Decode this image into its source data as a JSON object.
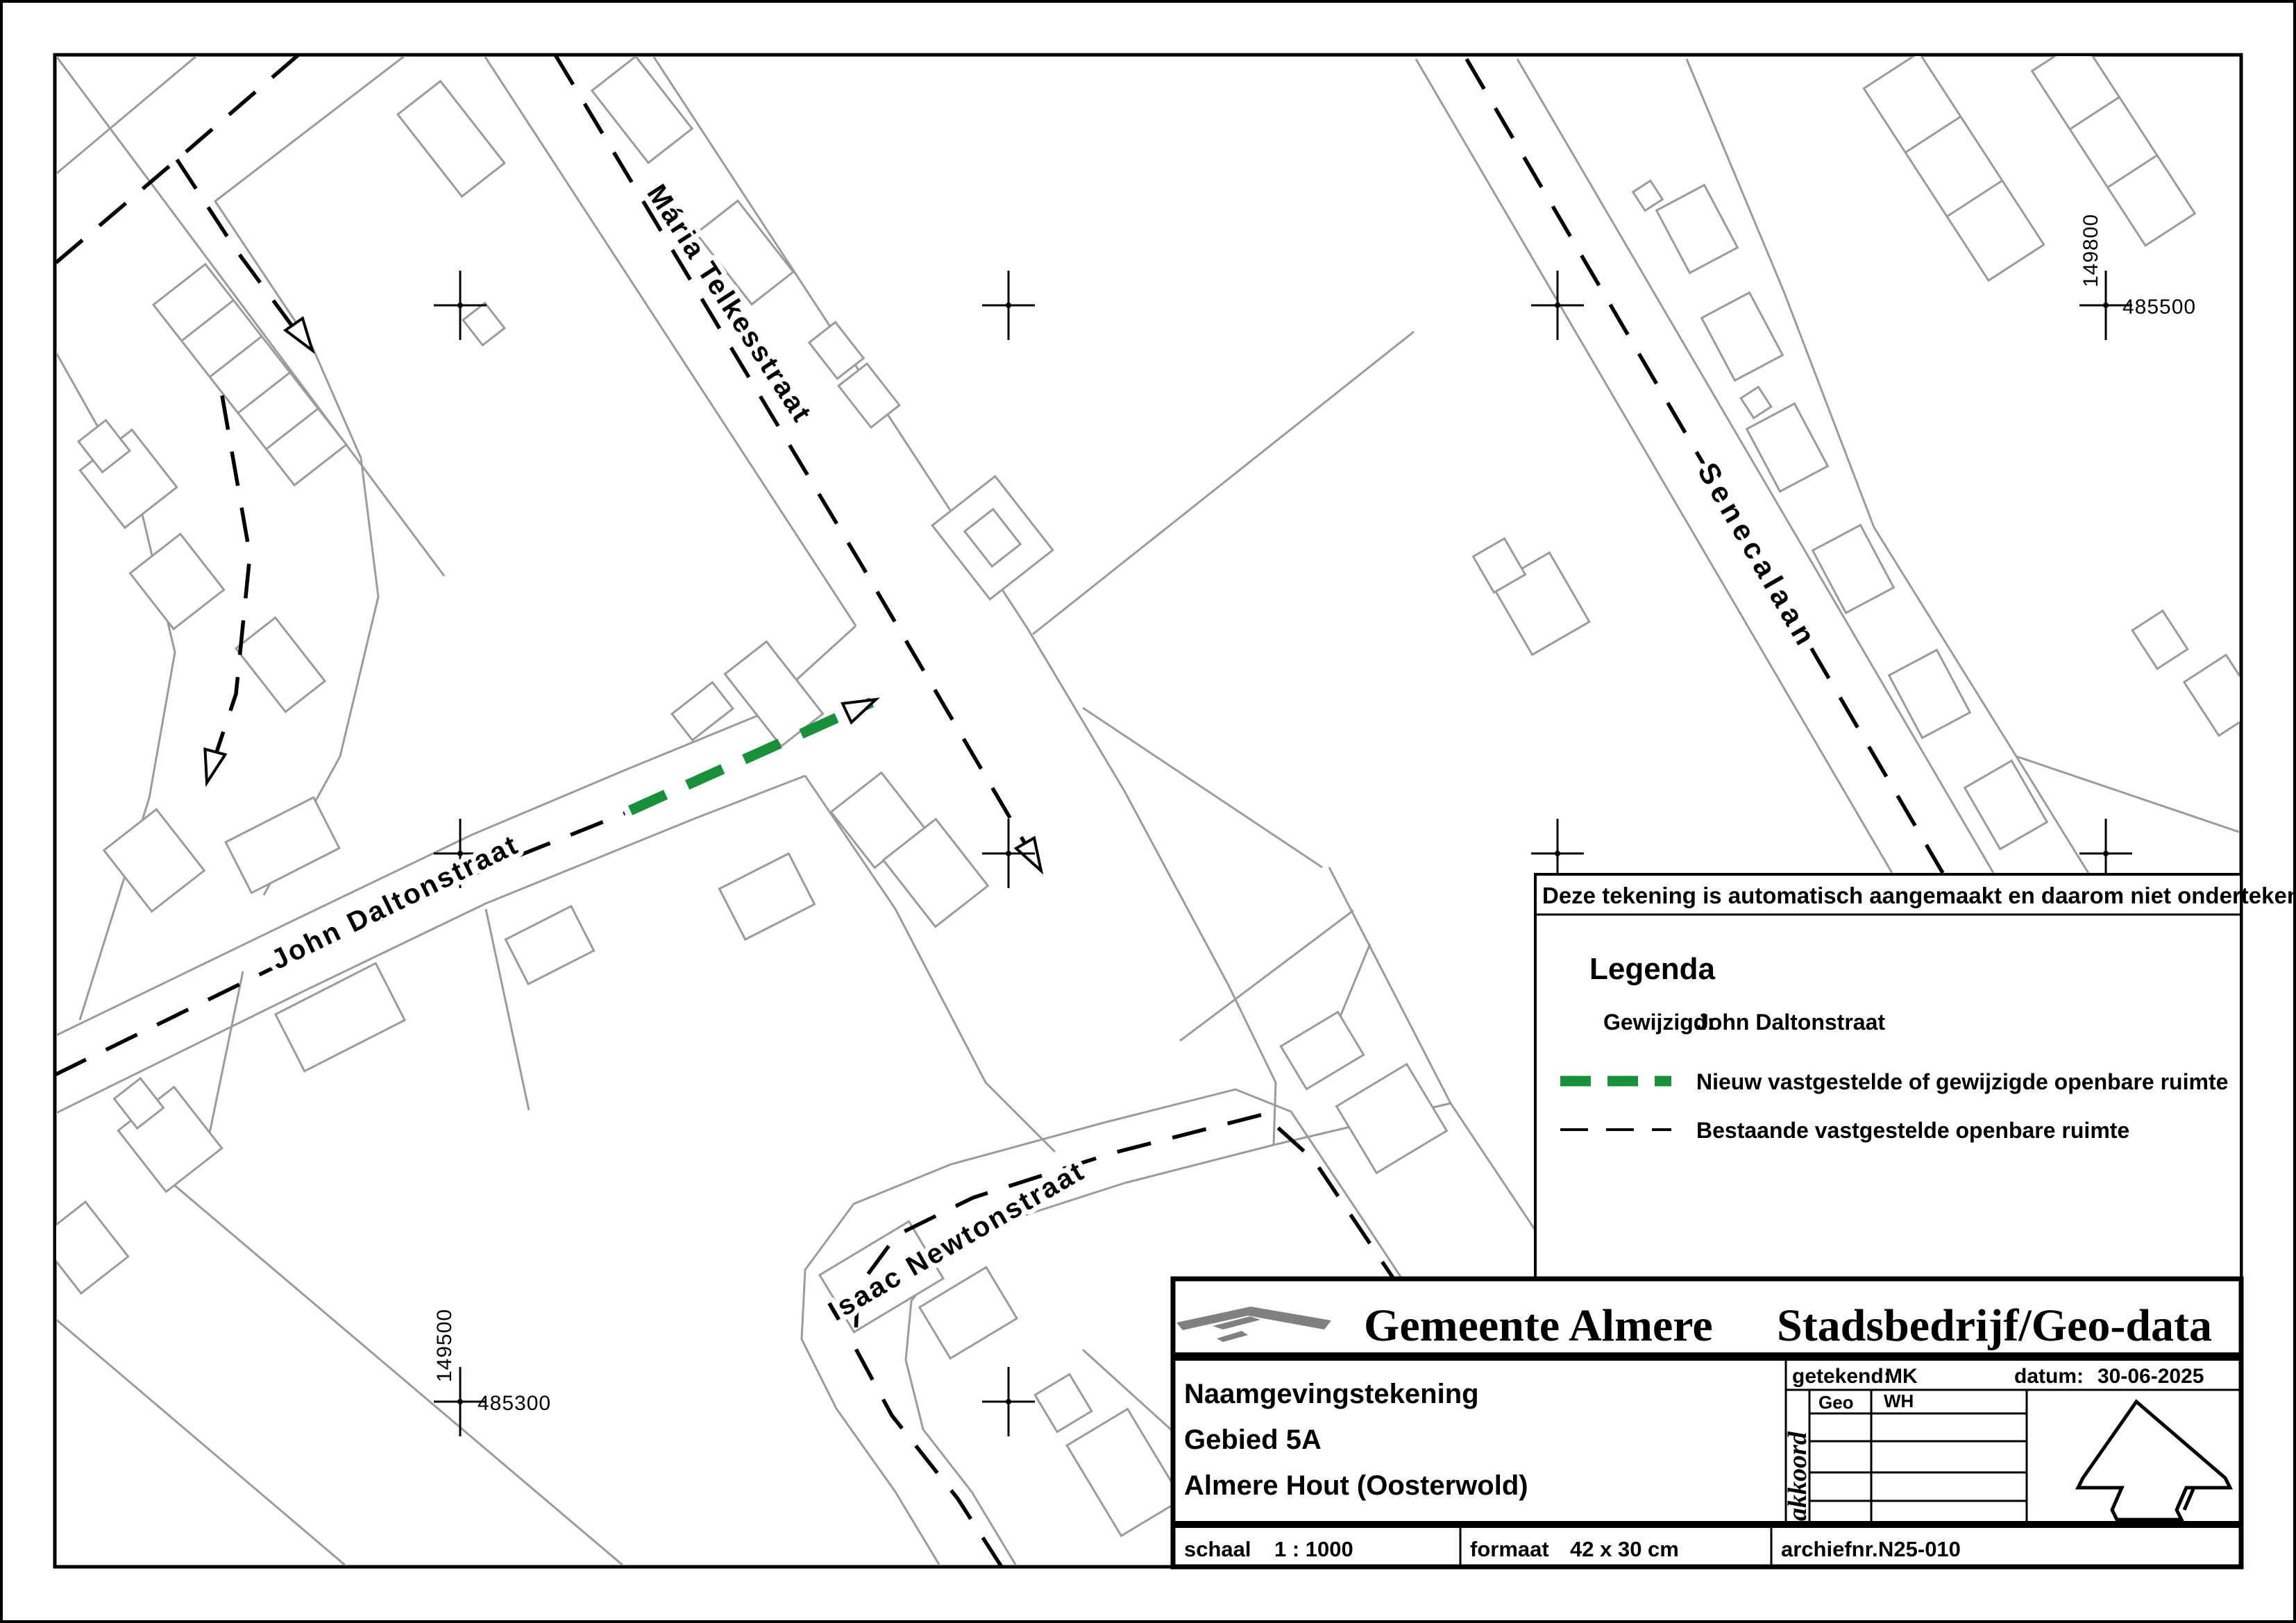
{
  "map": {
    "streets": [
      {
        "name": "Mária Telkesstraat"
      },
      {
        "name": "John Daltonstraat"
      },
      {
        "name": "Isaac Newtonstraat"
      },
      {
        "name": "Senecalaan"
      }
    ],
    "grid": {
      "right_v": "149800",
      "right_h": "485500",
      "left_v": "149500",
      "left_h": "485300"
    }
  },
  "legend": {
    "note": "Deze tekening is automatisch aangemaakt en daarom niet ondertekend",
    "title": "Legenda",
    "changed_label": "Gewijzigd:",
    "changed_value": "John Daltonstraat",
    "new_space": "Nieuw vastgestelde of gewijzigde openbare ruimte",
    "existing_space": "Bestaande vastgestelde openbare ruimte",
    "new_color": "#18913a"
  },
  "title_block": {
    "org": "Gemeente Almere",
    "dept": "Stadsbedrijf/Geo-data",
    "drawn_label": "getekend:",
    "drawn_value": "MK",
    "date_label": "datum:",
    "date_value": "30-06-2025",
    "doc_type": "Naamgevingstekening",
    "area": "Gebied 5A",
    "district": "Almere Hout  (Oosterwold)",
    "approve_label": "akkoord",
    "approve_rows": [
      {
        "dept": "Geo",
        "initials": "WH"
      }
    ],
    "scale_label": "schaal",
    "scale_value": "1 : 1000",
    "format_label": "formaat",
    "format_value": "42 x 30 cm",
    "archive_label": "archiefnr.",
    "archive_value": "N25-010"
  }
}
